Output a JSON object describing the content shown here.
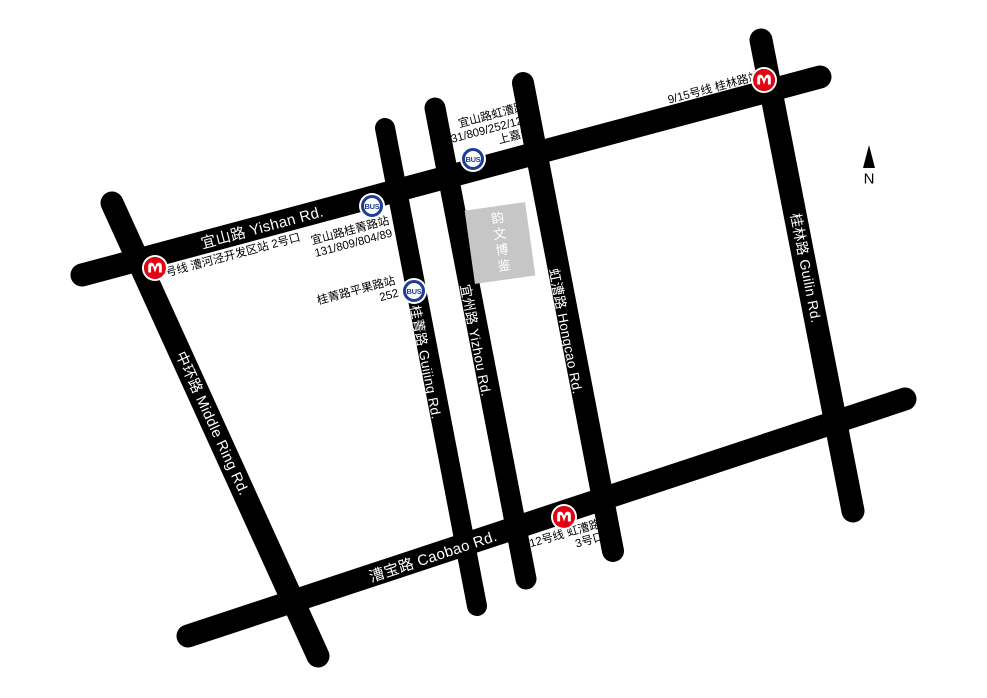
{
  "map": {
    "roads": [
      {
        "id": "yishan",
        "label": "宜山路 Yishan Rd."
      },
      {
        "id": "middle_ring",
        "label": "中环路 Middle Ring Rd."
      },
      {
        "id": "caobao",
        "label": "漕宝路 Caobao Rd."
      },
      {
        "id": "guijing",
        "label": "桂菁路 Guijing Rd."
      },
      {
        "id": "yizhou",
        "label": "宜州路 Yizhou Rd."
      },
      {
        "id": "hongcao",
        "label": "虹漕路 Hongcao Rd."
      },
      {
        "id": "guilin",
        "label": "桂林路 Guilin Rd."
      }
    ],
    "metro": {
      "caohejing": {
        "label": "9号线 漕河泾开发区站 2号口"
      },
      "guilin_road": {
        "label": "9/15号线 桂林路站"
      },
      "hongcao_road": {
        "line1": "12号线 虹漕路",
        "line2": "3号口"
      }
    },
    "bus": {
      "icon_label": "BUS",
      "yishan_guijing": {
        "line1": "宜山路桂菁路站",
        "line2": "131/809/804/89"
      },
      "guijing_pingguo": {
        "line1": "桂菁路平果路站",
        "line2": "252"
      },
      "yishan_hongcao": {
        "line1": "宜山路虹漕路",
        "line2": "131/809/252/120",
        "line3": "上嘉线"
      }
    },
    "building": {
      "label": "韵文博鉴"
    },
    "compass": {
      "label": "N"
    },
    "colors": {
      "road": "#000000",
      "metro_red": "#e60012",
      "bus_blue": "#1d3e94",
      "building_gray": "#c6c6c6",
      "road_label": "#ffffff"
    }
  }
}
